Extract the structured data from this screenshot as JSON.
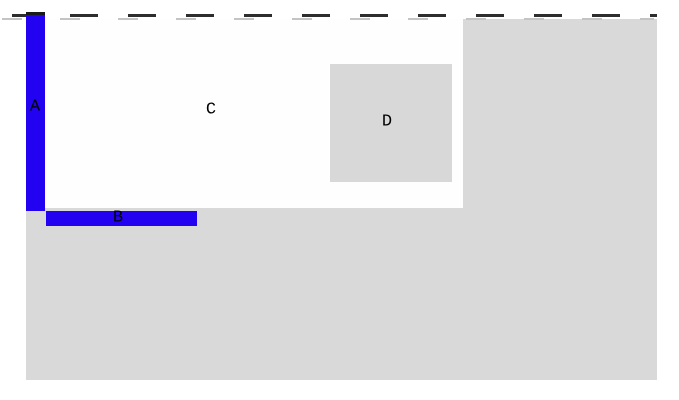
{
  "colors": {
    "page_bg": "#ffffff",
    "plot_gray": "#d9d9d9",
    "region_white": "#fefefe",
    "square_gray": "#d8d8d8",
    "bar_blue": "#2302f2",
    "bar_edge": "#1a1a1a",
    "dash_dark": "#2e2e2e",
    "dash_light": "#c4c4c4",
    "label_ink": "#000000"
  },
  "regions": {
    "A": {
      "label": "A"
    },
    "B": {
      "label": "B"
    },
    "C": {
      "label": "C"
    },
    "D": {
      "label": "D"
    }
  }
}
